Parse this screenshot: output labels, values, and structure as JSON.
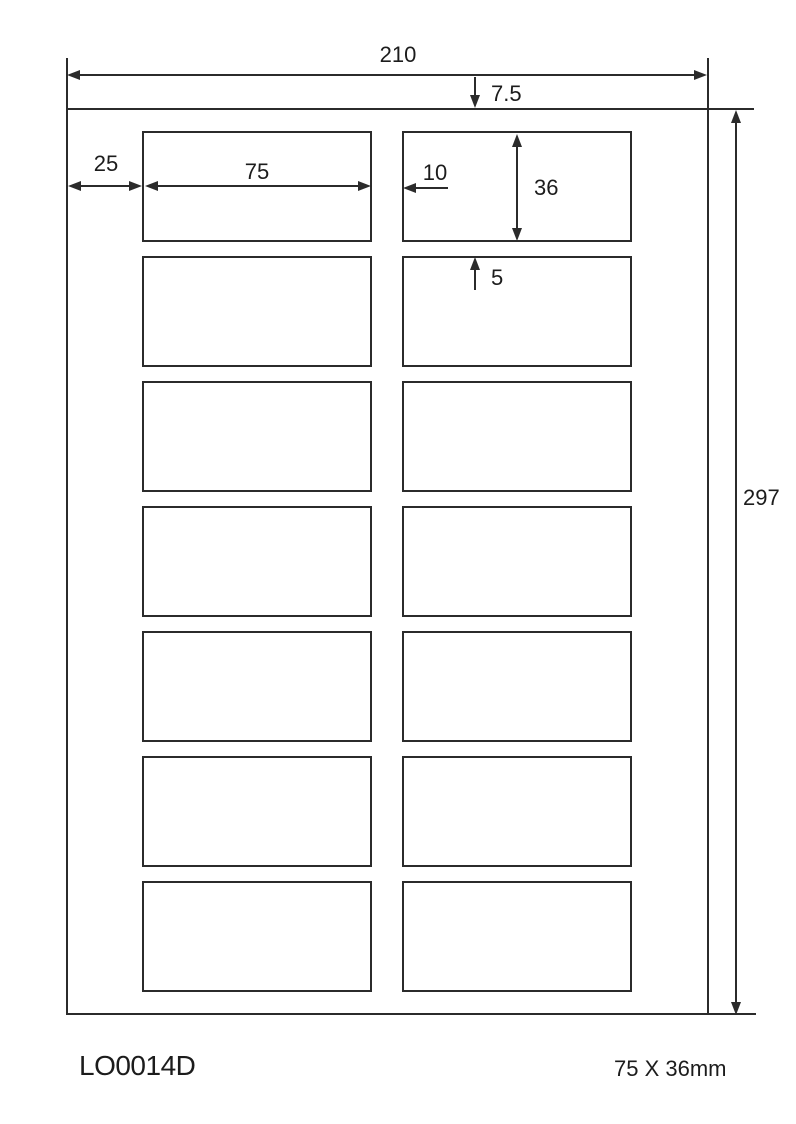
{
  "diagram": {
    "dims": {
      "sheet_width_mm": "210",
      "top_margin_mm": "7.5",
      "left_margin_mm": "25",
      "label_width_mm": "75",
      "column_gap_mm": "10",
      "label_height_mm": "36",
      "row_gap_mm": "5",
      "sheet_height_mm": "297"
    },
    "footer": {
      "product_code": "LO0014D",
      "label_size": "75 X 36mm"
    },
    "grid": {
      "columns": 2,
      "rows": 7,
      "labels_total": 14
    },
    "colors": {
      "line": "#2b2b2b",
      "text": "#1c1c1c",
      "background": "#ffffff"
    }
  }
}
